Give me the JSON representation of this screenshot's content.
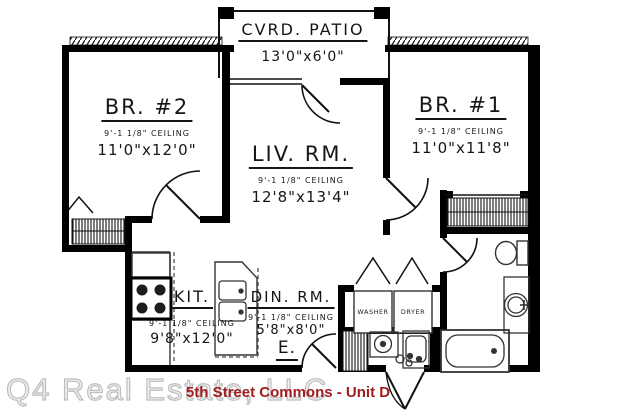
{
  "meta": {
    "plan_title": "5th Street Commons - Unit D",
    "watermark": "Q4 Real Estate, LLC"
  },
  "colors": {
    "walls": "#000000",
    "background": "#ffffff",
    "title_red": "#a01d1f",
    "watermark_gray": "#bdbdbd"
  },
  "rooms": {
    "patio": {
      "name": "CVRD. PATIO",
      "dims": "13'0\"x6'0\""
    },
    "bedroom2": {
      "name": "BR. #2",
      "ceiling": "9'-1 1/8\" CEILING",
      "dims": "11'0\"x12'0\""
    },
    "bedroom1": {
      "name": "BR. #1",
      "ceiling": "9'-1 1/8\" CEILING",
      "dims": "11'0\"x11'8\""
    },
    "living": {
      "name": "LIV. RM.",
      "ceiling": "9'-1 1/8\" CEILING",
      "dims": "12'8\"x13'4\""
    },
    "kitchen": {
      "name": "KIT.",
      "ceiling": "9'-1 1/8\" CEILING",
      "dims": "9'8\"x12'0\""
    },
    "dining": {
      "name": "DIN. RM.",
      "ceiling": "9'-1 1/8\" CEILING",
      "dims": "5'8\"x8'0\""
    },
    "entry": {
      "name": "E."
    },
    "laundry": {
      "washer": "WASHER",
      "dryer": "DRYER"
    }
  }
}
